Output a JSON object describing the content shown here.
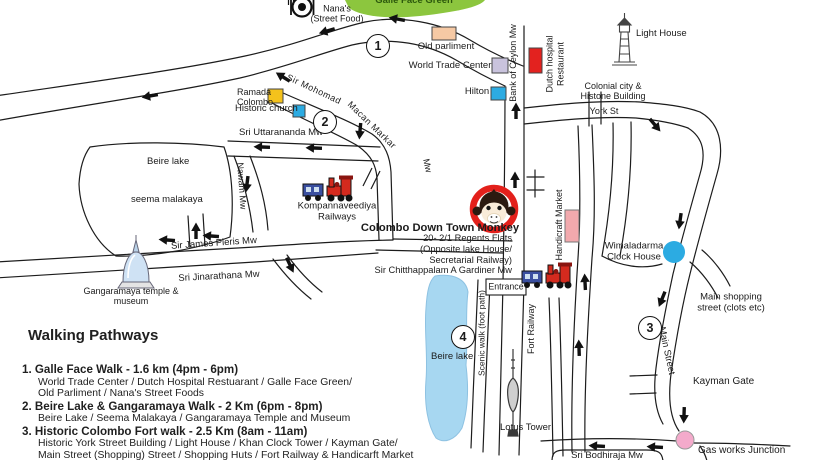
{
  "map": {
    "labels": {
      "galle_face_green": "Galle Face Green",
      "nanas_1": "Nana's",
      "nanas_2": "(Street Food)",
      "old_parliament": "Old parliment",
      "world_trade_center": "World Trade Center",
      "hilton": "Hilton",
      "bank_of_ceylon_mw": "Bank of Ceylon Mw",
      "dutch_hospital_1": "Dutch hospital",
      "dutch_hospital_2": "Restaurant",
      "light_house": "Light House",
      "colonial_1": "Colonial city &",
      "colonial_2": "Histone Building",
      "york_st": "York St",
      "ramada_1": "Ramada",
      "ramada_2": "Colombo",
      "historic_church": "Historic church",
      "macan_1": "Sir Mohomad",
      "macan_2": "Macan Markar",
      "macan_3": "Mw",
      "sri_uttarananda_mw": "Sri Uttarananda Mw",
      "beire_lake_west": "Beire lake",
      "seema_malakaya": "seema malakaya",
      "nawam_mw": "Nawam Mw",
      "sir_james_pieris_mw": "Sir James Pieris Mw",
      "sri_jinarathana_mw": "Sri Jinarathana Mw",
      "gangaramaya_1": "Gangaramaya temple &",
      "gangaramaya_2": "museum",
      "kompannaveediya_1": "Kompannaveediya",
      "kompannaveediya_2": "Railways",
      "handicraft_market": "Handicraft Market",
      "wimaladarma_1": "Wimaladarma",
      "wimaladarma_2": "Clock House",
      "main_shopping_1": "Main shopping",
      "main_shopping_2": "street (clots etc)",
      "main_street": "Main Street",
      "kayman_gate": "Kayman Gate",
      "gas_works_junction": "Gas works Junction",
      "lotus_tower": "Lotus Tower",
      "entrance": "Entrance",
      "scenic_walk": "Scenic walk (foot path)",
      "fort_railway": "Fort Railway",
      "beire_lake_south": "Beire lake",
      "sri_bodhiraja_mw": "Sri Bodhiraja Mw"
    },
    "brand": {
      "title": "Colombo Down Town Monkey",
      "old_address_1": "20- 2/1 Regents Flats",
      "old_address_2": "(Opposite lake House/",
      "new_address_1": "Secretarial Railway)",
      "new_address_2": "Sir Chitthappalam A Gardiner Mw"
    },
    "badges": {
      "one": "1",
      "two": "2",
      "three": "3",
      "four": "4"
    },
    "icons": {
      "street_food": "fork-and-plate",
      "light_house": "lighthouse",
      "railways": "steam-train",
      "brand": "monkey-face",
      "temple": "stupa",
      "lotus_tower": "tower"
    },
    "colors": {
      "marker_red": "#e3221f",
      "marker_yellow": "#f4c21c",
      "marker_blue": "#2cabe2",
      "marker_purple": "#c9c3dd",
      "marker_peach": "#f6c9a4",
      "marker_pink": "#f2a9ad",
      "junction_pink": "#f4aacb",
      "lake_blue": "#a7d7f1",
      "park_green": "#8cc63e",
      "brand_ring_red": "#e3201b"
    }
  },
  "walking_pathways": {
    "title": "Walking Pathways",
    "items": [
      {
        "header": "1. Galle Face Walk - 1.6 km (4pm - 6pm)",
        "lines": [
          "World Trade Center / Dutch Hospital Restuarant / Galle Face Green/",
          "Old Parliment / Nana's Street Foods"
        ]
      },
      {
        "header": "2. Beire Lake & Gangaramaya Walk - 2 Km (6pm - 8pm)",
        "lines": [
          "Beire Lake / Seema Malakaya / Gangaramaya Temple and Museum"
        ]
      },
      {
        "header": "3. Historic Colombo Fort walk - 2.5 Km (8am - 11am)",
        "lines": [
          "Historic York Street Building / Light House / Khan Clock Tower / Kayman Gate/",
          "Main Street (Shopping) Street / Shopping Huts / Fort Railway & Handicarft Market"
        ]
      }
    ]
  }
}
